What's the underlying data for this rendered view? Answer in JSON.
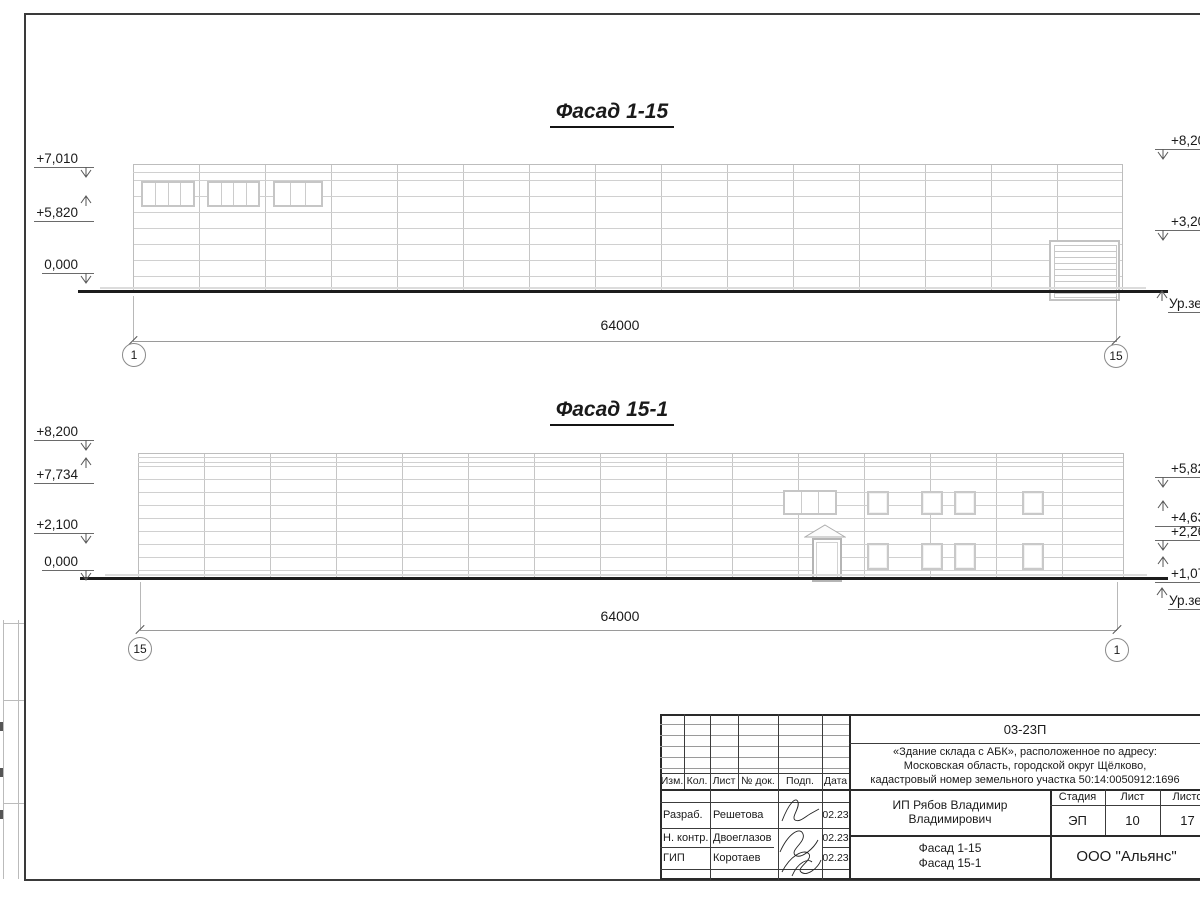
{
  "facade1": {
    "title": "Фасад 1-15",
    "dim": "64000",
    "axis_left": "1",
    "axis_right": "15",
    "marks_left": [
      {
        "label": "+7,010"
      },
      {
        "label": "+5,820"
      },
      {
        "label": "0,000"
      }
    ],
    "marks_right": [
      {
        "label": "+8,20"
      },
      {
        "label": "+3,20"
      }
    ],
    "ground_right": "Ур.зе"
  },
  "facade2": {
    "title": "Фасад 15-1",
    "dim": "64000",
    "axis_left": "15",
    "axis_right": "1",
    "marks_left": [
      {
        "label": "+8,200"
      },
      {
        "label": "+7,734"
      },
      {
        "label": "+2,100"
      },
      {
        "label": "0,000"
      }
    ],
    "marks_right": [
      {
        "label": "+5,82"
      },
      {
        "label": "+4,63"
      },
      {
        "label": "+2,26"
      },
      {
        "label": "+1,07"
      }
    ],
    "ground_right": "Ур.зе"
  },
  "titleblock": {
    "code": "03-23П",
    "address": {
      "line1": "«Здание склада с АБК», расположенное по адресу:",
      "line2": "Московская область, городской округ Щёлково,",
      "line3": "кадастровый номер земельного участка 50:14:0050912:1696"
    },
    "columns": {
      "c1": "Изм.",
      "c2": "Кол.",
      "c3": "Лист",
      "c4": "№ док.",
      "c5": "Подп.",
      "c6": "Дата"
    },
    "staff": [
      {
        "role": "Разраб.",
        "name": "Решетова",
        "date": "02.23"
      },
      {
        "role": "Н. контр.",
        "name": "Двоеглазов",
        "date": "02.23"
      },
      {
        "role": "ГИП",
        "name": "Коротаев",
        "date": "02.23"
      }
    ],
    "client": "ИП Рябов Владимир Владимирович",
    "stage_label": "Стадия",
    "sheet_label": "Лист",
    "sheets_label": "Листо",
    "stage": "ЭП",
    "sheet": "10",
    "sheets": "17",
    "drawing_title_line1": "Фасад 1-15",
    "drawing_title_line2": "Фасад 15-1",
    "company": "ООО \"Альянс\""
  }
}
